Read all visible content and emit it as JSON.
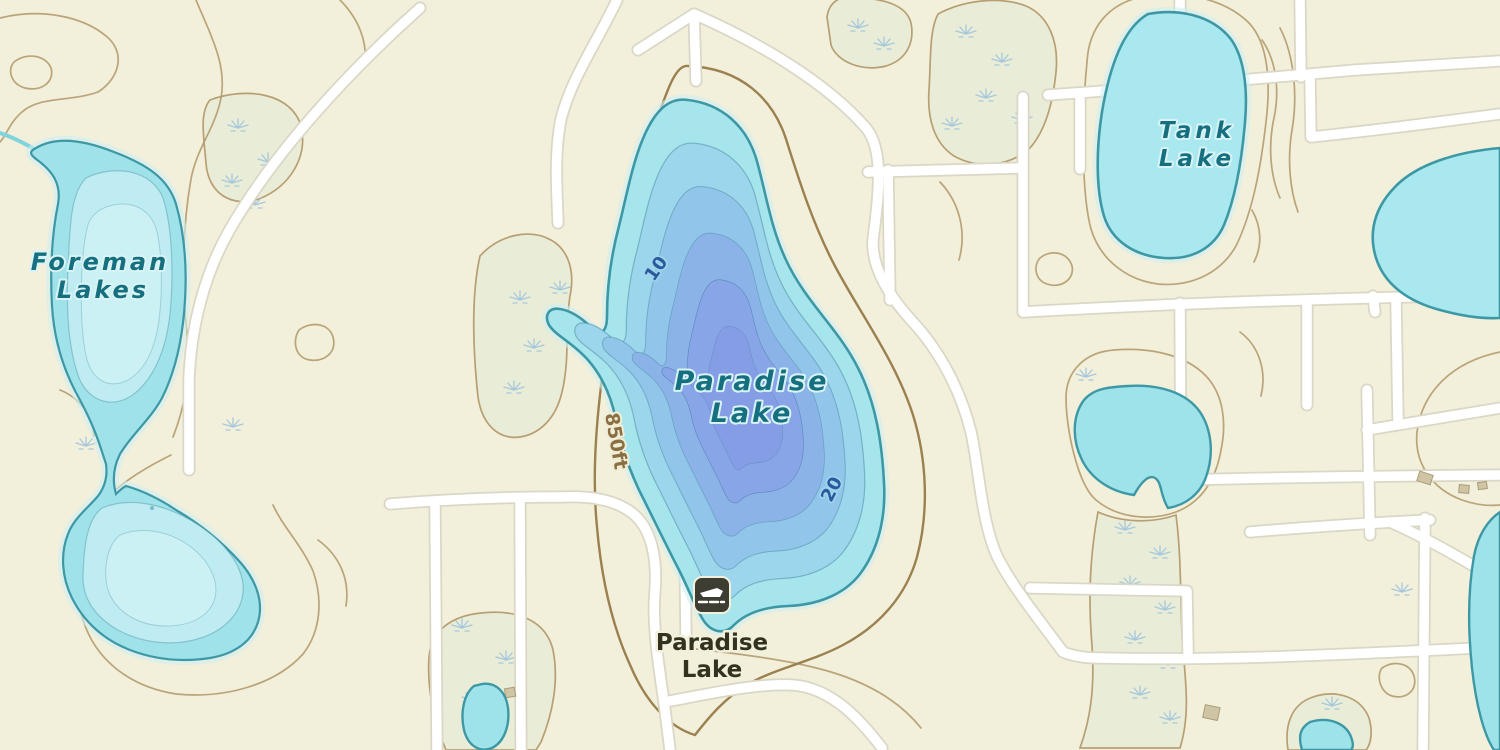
{
  "map": {
    "water_labels": {
      "foreman": {
        "line1": "Foreman",
        "line2": "Lakes"
      },
      "paradise": {
        "line1": "Paradise",
        "line2": "Lake"
      },
      "tank": {
        "line1": "Tank",
        "line2": "Lake"
      }
    },
    "poi": {
      "boat_launch": {
        "name_line1": "Paradise",
        "name_line2": "Lake",
        "icon": "boat-launch-icon"
      }
    },
    "annotations": {
      "elevation_contour": "850ft",
      "depth_contour_shallow": "10",
      "depth_contour_deep": "20"
    },
    "colors": {
      "land": "#f2efda",
      "marsh_fill": "#e9edd8",
      "marsh_symbol": "#9fc3dd",
      "contour": "#b49b6e",
      "index_contour": "#9b8050",
      "road_fill": "#ffffff",
      "road_casing": "#dbd7c6",
      "water_shallow": "#a9e8ee",
      "water_mid": "#92c5ea",
      "water_deep": "#849de5",
      "water_outline": "#3d98a6",
      "stream": "#7fd4de",
      "water_label": "#166f7e",
      "depth_label": "#2a5a9c",
      "elevation_label": "#8a6f42",
      "poi_label": "#32321f",
      "poi_icon_bg": "#3d3d32"
    }
  }
}
